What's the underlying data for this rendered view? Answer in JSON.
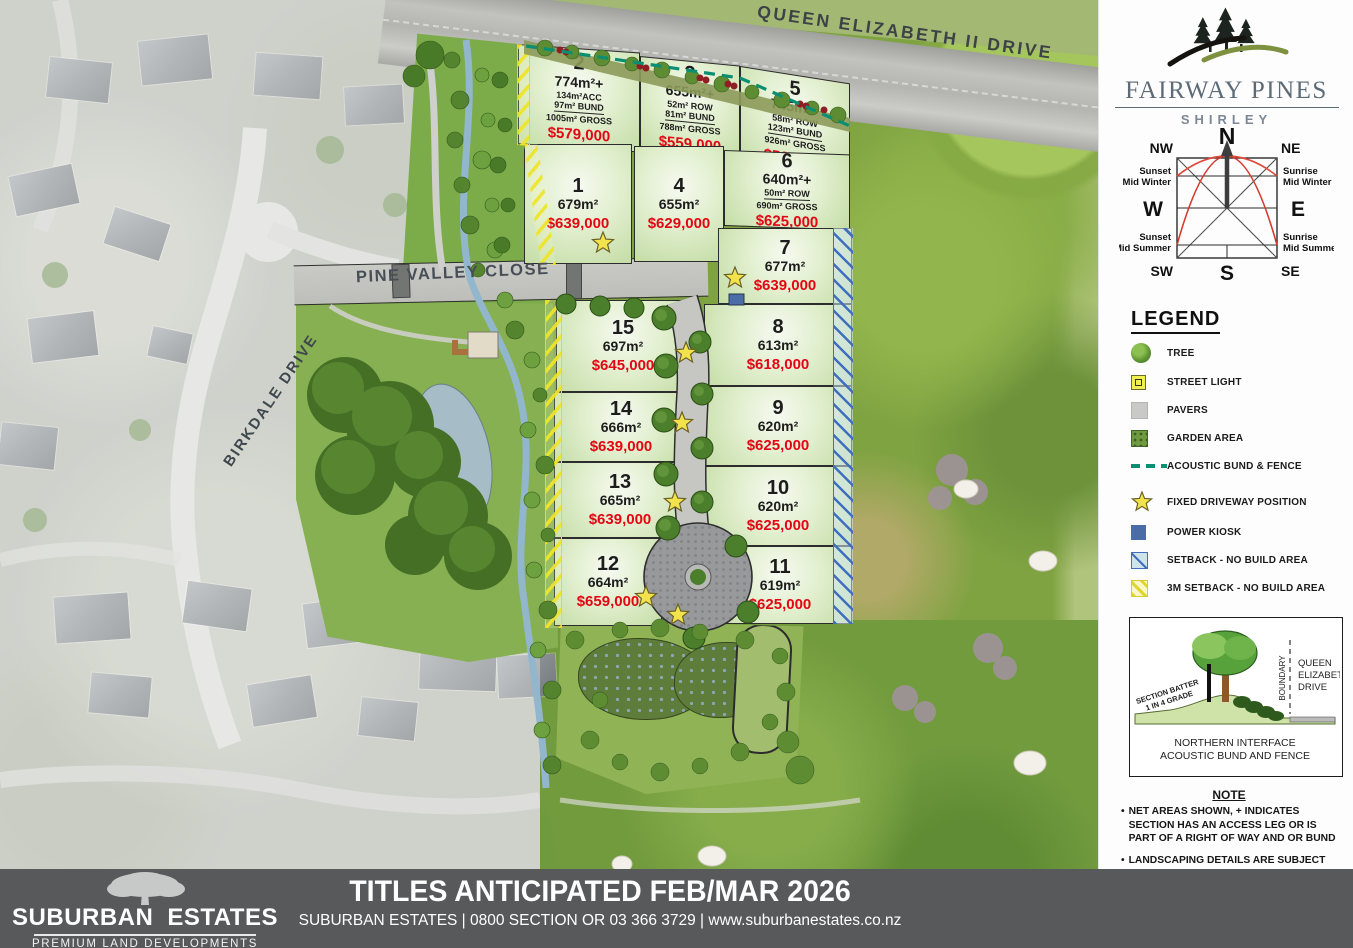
{
  "map": {
    "roads": {
      "qe2": "QUEEN ELIZABETH II DRIVE",
      "pvc": "PINE VALLEY CLOSE",
      "birkdale": "BIRKDALE DRIVE"
    },
    "lots": [
      {
        "id": "2",
        "area": "774m²+",
        "sub1": "134m²ACC",
        "sub2": "97m² BUND",
        "sub3": "1005m² GROSS",
        "price": "$579,000"
      },
      {
        "id": "3",
        "area": "655m²+",
        "sub1": "52m² ROW",
        "sub2": "81m² BUND",
        "sub3": "788m² GROSS",
        "price": "$559,000"
      },
      {
        "id": "5",
        "area": "745m²+",
        "sub1": "58m² ROW",
        "sub2": "123m² BUND",
        "sub3": "926m² GROSS",
        "price": "$569,000"
      },
      {
        "id": "1",
        "area": "679m²",
        "price": "$639,000"
      },
      {
        "id": "4",
        "area": "655m²",
        "price": "$629,000"
      },
      {
        "id": "6",
        "area": "640m²+",
        "sub1": "50m² ROW",
        "sub3": "690m² GROSS",
        "price": "$625,000"
      },
      {
        "id": "7",
        "area": "677m²",
        "price": "$639,000"
      },
      {
        "id": "8",
        "area": "613m²",
        "price": "$618,000"
      },
      {
        "id": "9",
        "area": "620m²",
        "price": "$625,000"
      },
      {
        "id": "10",
        "area": "620m²",
        "price": "$625,000"
      },
      {
        "id": "11",
        "area": "619m²",
        "price": "$625,000"
      },
      {
        "id": "15",
        "area": "697m²",
        "price": "$645,000"
      },
      {
        "id": "14",
        "area": "666m²",
        "price": "$639,000"
      },
      {
        "id": "13",
        "area": "665m²",
        "price": "$639,000"
      },
      {
        "id": "12",
        "area": "664m²",
        "price": "$659,000"
      }
    ]
  },
  "panel": {
    "brand": {
      "title": "FAIRWAY PINES",
      "subtitle": "SHIRLEY"
    },
    "compass": {
      "n": "N",
      "ne": "NE",
      "e": "E",
      "se": "SE",
      "s": "S",
      "sw": "SW",
      "w": "W",
      "nw": "NW",
      "sunset_winter": [
        "Sunset",
        "Mid Winter"
      ],
      "sunrise_winter": [
        "Sunrise",
        "Mid Winter"
      ],
      "sunset_summer": [
        "Sunset",
        "Mid Summer"
      ],
      "sunrise_summer": [
        "Sunrise",
        "Mid Summer"
      ]
    },
    "legend": {
      "title": "LEGEND",
      "items": [
        {
          "label": "TREE"
        },
        {
          "label": "STREET LIGHT"
        },
        {
          "label": "PAVERS"
        },
        {
          "label": "GARDEN AREA"
        },
        {
          "label": "ACOUSTIC BUND & FENCE"
        },
        {
          "label": "FIXED DRIVEWAY POSITION"
        },
        {
          "label": "POWER KIOSK"
        },
        {
          "label": "SETBACK - NO BUILD AREA"
        },
        {
          "label": "3M SETBACK - NO BUILD AREA"
        }
      ]
    },
    "interface": {
      "batter1": "SECTION BATTER",
      "batter2": "1 IN 4 GRADE",
      "boundary": "BOUNDARY",
      "road1": "QUEEN",
      "road2": "ELIZABETH II",
      "road3": "DRIVE",
      "caption1": "NORTHERN INTERFACE",
      "caption2": "ACOUSTIC BUND AND FENCE"
    },
    "note": {
      "title": "NOTE",
      "bullets": [
        "NET AREAS SHOWN, + INDICATES SECTION HAS AN ACCESS LEG OR IS PART OF A RIGHT OF WAY AND OR BUND",
        "LANDSCAPING DETAILS ARE SUBJECT TO CHANGE."
      ]
    }
  },
  "footer": {
    "title": "TITLES ANTICIPATED FEB/MAR 2026",
    "contact": "SUBURBAN ESTATES | 0800 SECTION OR 03 366 3729 | www.suburbanestates.co.nz",
    "logo": {
      "word1": "SUBURBAN",
      "word2": "ESTATES",
      "tagline": "PREMIUM LAND DEVELOPMENTS"
    }
  },
  "colors": {
    "price_red": "#e30613",
    "acoustic_teal": "#0a8f72",
    "kiosk_blue": "#4a6da7",
    "setback_blue": "#3f6fbe",
    "hatch_yellow": "#e4dc20",
    "footer_gray": "#58595b"
  }
}
